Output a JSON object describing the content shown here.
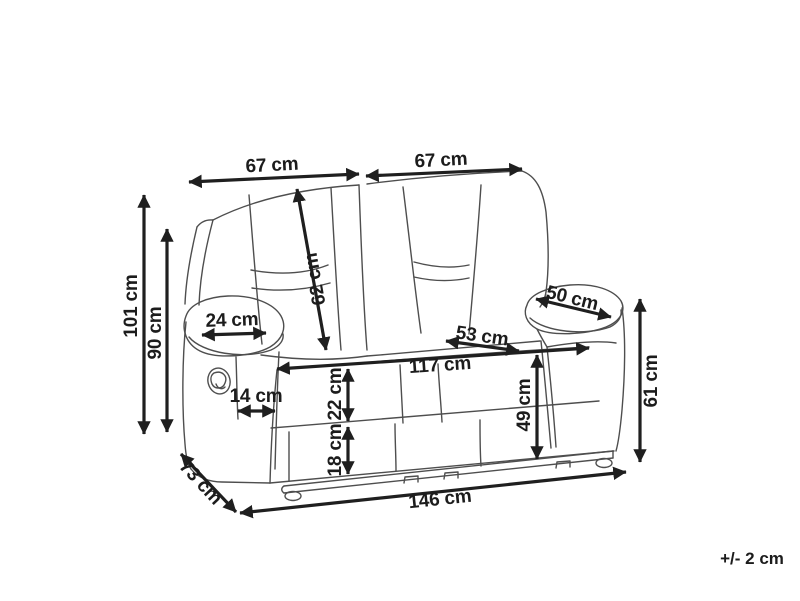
{
  "diagram": {
    "type": "product-dimension-line-drawing",
    "subject": "two-seat recliner sofa",
    "unit": "cm",
    "tolerance_note": "+/- 2 cm",
    "dims": {
      "back_width_left": "67 cm",
      "back_width_right": "67 cm",
      "backrest_diagonal": "62 cm",
      "overall_height": "101 cm",
      "backrest_height": "90 cm",
      "armrest_top_width": "24 cm",
      "armrest_top_depth": "50 cm",
      "seat_depth": "53 cm",
      "inner_width": "117 cm",
      "armrest_front_width": "14 cm",
      "front_upper_band_height": "22 cm",
      "front_lower_band_height": "18 cm",
      "seat_front_height": "49 cm",
      "armrest_height": "61 cm",
      "overall_depth": "73 cm",
      "overall_width": "146 cm"
    }
  }
}
